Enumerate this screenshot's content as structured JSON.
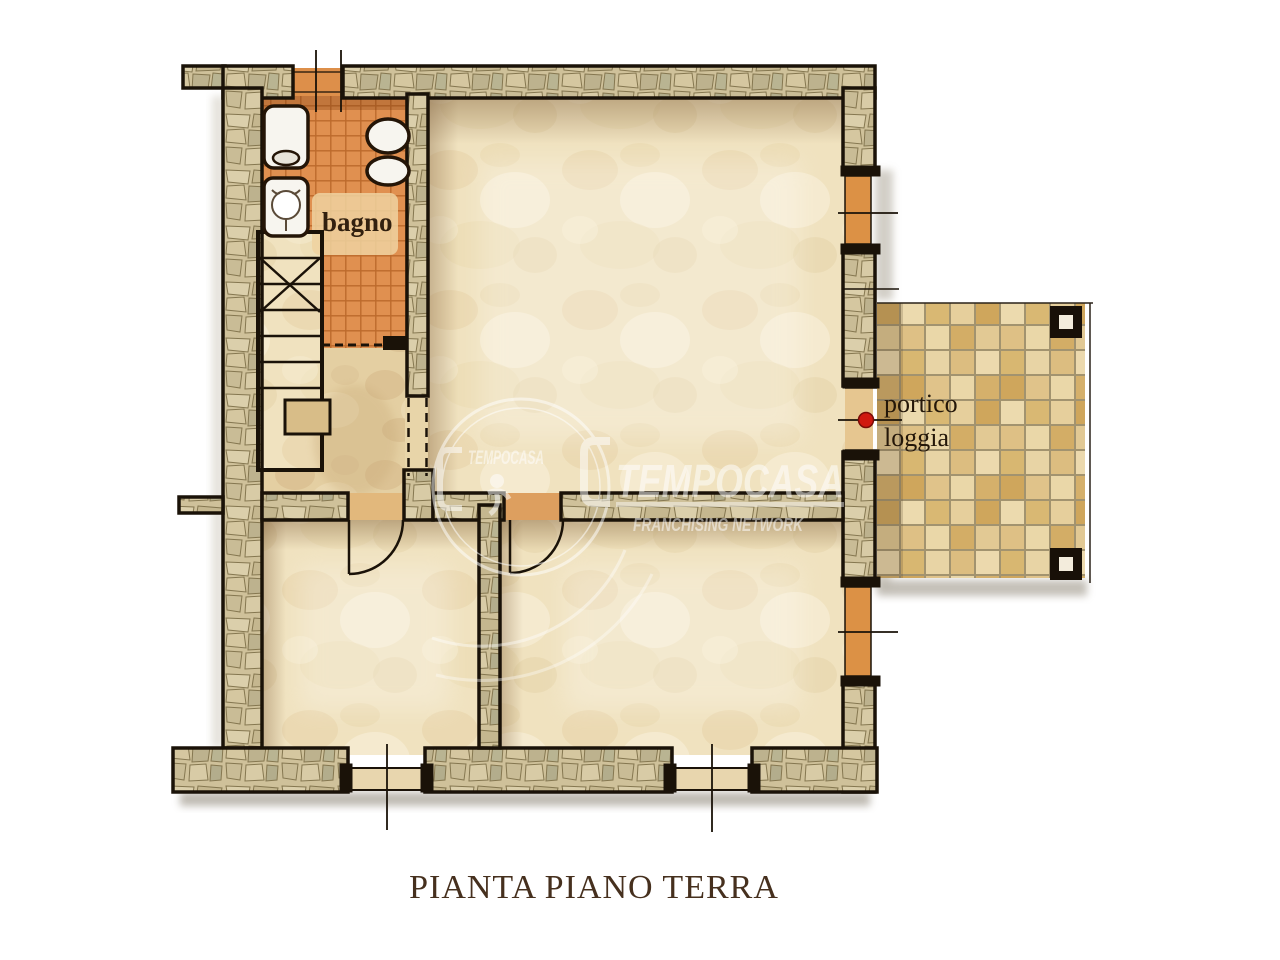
{
  "title": {
    "text": "PIANTA PIANO TERRA"
  },
  "rooms": {
    "bathroom_label": "bagno"
  },
  "portico": {
    "label_line1": "portico",
    "label_line2": "loggia"
  },
  "watermark": {
    "brand_large": "TEMPOCASA",
    "brand_small": "TEMPOCASA",
    "tagline": "FRANCHISING NETWORK"
  },
  "colors": {
    "wall_outline": "#1a1208",
    "wall_stone": "#cfc19a",
    "tile_orange": "#e09050",
    "floor_parchment": "#f0e2bf",
    "hall_floor": "#e4cfa2",
    "portico_stone": "#d9b873",
    "marker_red": "#d01910",
    "title_brown": "#46301e"
  }
}
